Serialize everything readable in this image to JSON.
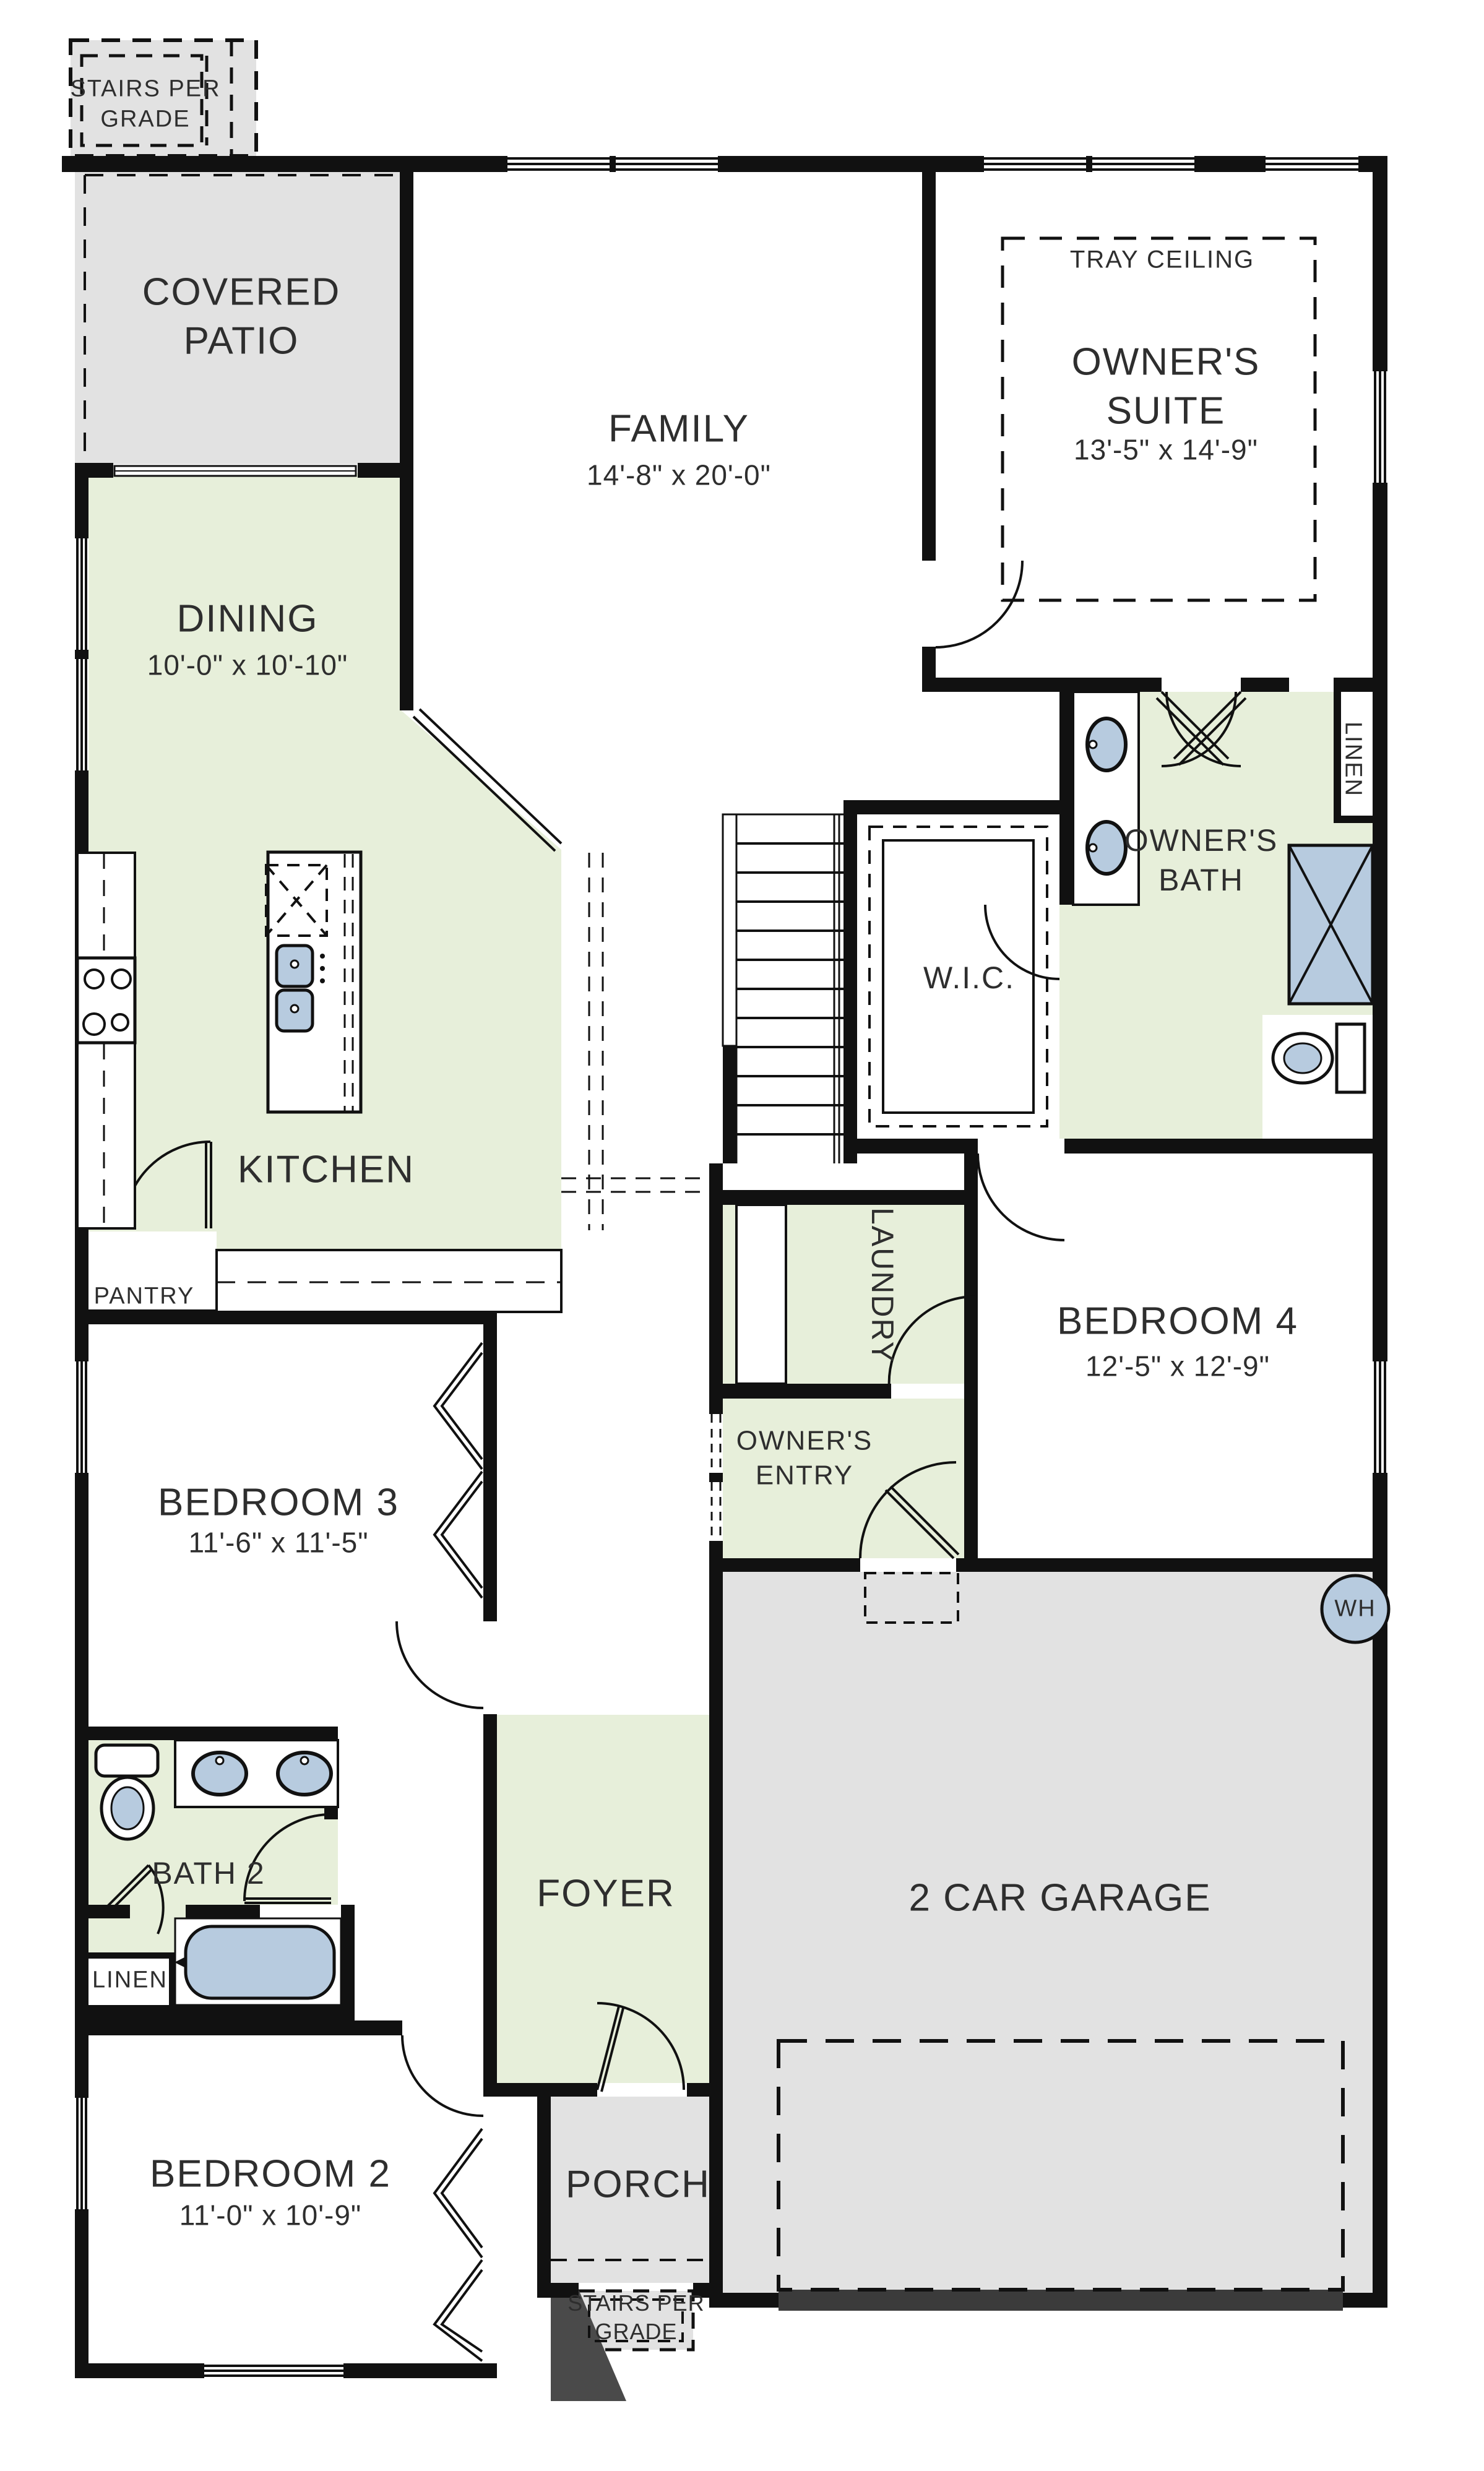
{
  "colors": {
    "wall": "#111111",
    "room_green": "#e7efda",
    "outdoor_gray": "#e2e2e2",
    "fixture_blue": "#b7cbdf",
    "garage_door_bar": "#3b3b3b",
    "text": "#2e2e2e"
  },
  "rooms": {
    "stairs_top": {
      "label": "STAIRS PER GRADE"
    },
    "covered_patio": {
      "label": "COVERED PATIO"
    },
    "family": {
      "label": "FAMILY",
      "dims": "14'-8\" x 20'-0\""
    },
    "tray": {
      "label": "TRAY CEILING"
    },
    "owners_suite": {
      "label": "OWNER'S SUITE",
      "dims": "13'-5\" x 14'-9\""
    },
    "dining": {
      "label": "DINING",
      "dims": "10'-0\" x 10'-10\""
    },
    "kitchen": {
      "label": "KITCHEN"
    },
    "pantry": {
      "label": "PANTRY"
    },
    "linen_suite": {
      "label": "LINEN"
    },
    "owners_bath": {
      "label": "OWNER'S BATH"
    },
    "wic": {
      "label": "W.I.C."
    },
    "laundry": {
      "label": "LAUNDRY"
    },
    "bedroom4": {
      "label": "BEDROOM 4",
      "dims": "12'-5\" x 12'-9\""
    },
    "owners_entry": {
      "label": "OWNER'S ENTRY"
    },
    "bedroom3": {
      "label": "BEDROOM 3",
      "dims": "11'-6\" x 11'-5\""
    },
    "water_heater": {
      "label": "WH"
    },
    "bath2": {
      "label": "BATH 2"
    },
    "linen_bath": {
      "label": "LINEN"
    },
    "foyer": {
      "label": "FOYER"
    },
    "garage": {
      "label": "2 CAR GARAGE"
    },
    "bedroom2": {
      "label": "BEDROOM 2",
      "dims": "11'-0\" x 10'-9\""
    },
    "porch": {
      "label": "PORCH"
    },
    "stairs_bottom": {
      "label": "STAIRS PER GRADE"
    }
  }
}
